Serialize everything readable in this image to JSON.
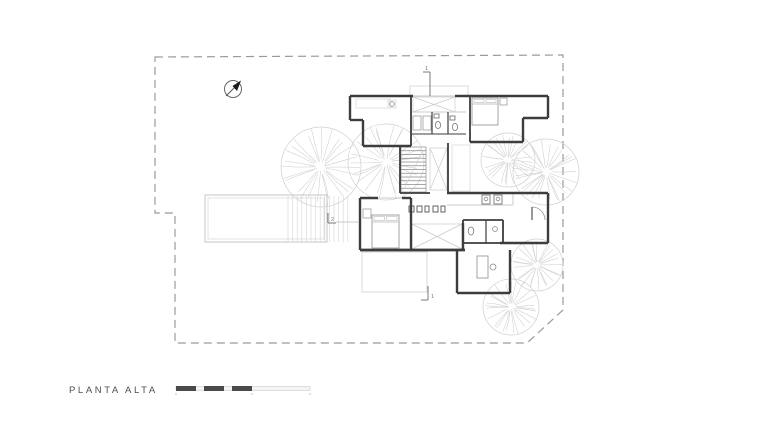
{
  "title": {
    "label": "PLANTA ALTA"
  },
  "colors": {
    "wall": "#3d3d3d",
    "light": "#c9c9c9",
    "lighter": "#dcdcdc",
    "medium": "#8d8d8d",
    "tree": "#cfcfcf",
    "boundary": "#9a9a9a",
    "text": "#4f4f4f",
    "marker": "#7a7a7a",
    "scale_dark": "#4a4a4a",
    "scale_light_fill": "#f4f4f4",
    "scale_light_stroke": "#d8d8d8"
  },
  "drawing": {
    "boundary_points": "155,57 563,55 563,310 527,343 175,343 175,213 155,213",
    "north_arrow": {
      "cx": 233,
      "cy": 89,
      "r": 8.5
    },
    "pool": {
      "outer": [
        205,
        195,
        122,
        47
      ],
      "inner": [
        208,
        198,
        116,
        41
      ]
    },
    "deck": {
      "x1": 288,
      "x2": 350,
      "y1": 196,
      "y2": 242,
      "step": 4.6
    },
    "trees": [
      {
        "cx": 321,
        "cy": 167,
        "r": 40
      },
      {
        "cx": 386,
        "cy": 162,
        "r": 38
      },
      {
        "cx": 508,
        "cy": 160,
        "r": 27
      },
      {
        "cx": 546,
        "cy": 172,
        "r": 33
      },
      {
        "cx": 537,
        "cy": 265,
        "r": 26
      },
      {
        "cx": 511,
        "cy": 307,
        "r": 28
      }
    ],
    "walls": [
      [
        350,
        96,
        413,
        96,
        2.4
      ],
      [
        455,
        96,
        548,
        96,
        2.4
      ],
      [
        350,
        96,
        350,
        120,
        2.4
      ],
      [
        350,
        120,
        363,
        120,
        2.4
      ],
      [
        363,
        120,
        363,
        146,
        2.4
      ],
      [
        363,
        146,
        411,
        146,
        2.4
      ],
      [
        411,
        96,
        411,
        146,
        1.8
      ],
      [
        470,
        96,
        470,
        142,
        1.8
      ],
      [
        548,
        96,
        548,
        118,
        2.4
      ],
      [
        523,
        118,
        548,
        118,
        2.4
      ],
      [
        523,
        118,
        523,
        142,
        2.4
      ],
      [
        470,
        142,
        523,
        142,
        2.4
      ],
      [
        448,
        143,
        448,
        193,
        1.8
      ],
      [
        400,
        147,
        400,
        193,
        1.8
      ],
      [
        400,
        193,
        430,
        193,
        1.8
      ],
      [
        447,
        193,
        548,
        193,
        2.4
      ],
      [
        548,
        193,
        548,
        243,
        2.4
      ],
      [
        500,
        243,
        548,
        243,
        2.4
      ],
      [
        463,
        220,
        503,
        220,
        1.8
      ],
      [
        463,
        220,
        463,
        243,
        1.8
      ],
      [
        503,
        220,
        503,
        243,
        1.8
      ],
      [
        486,
        220,
        486,
        243,
        1.2
      ],
      [
        463,
        243,
        503,
        243,
        1.8
      ],
      [
        360,
        198,
        360,
        250,
        2.4
      ],
      [
        360,
        198,
        378,
        198,
        2.4
      ],
      [
        402,
        198,
        411,
        198,
        2.4
      ],
      [
        411,
        198,
        411,
        223,
        2.4
      ],
      [
        360,
        250,
        465,
        250,
        2.8
      ],
      [
        411,
        223,
        411,
        250,
        2.4
      ],
      [
        463,
        223,
        463,
        250,
        2.4
      ],
      [
        457,
        250,
        457,
        293,
        2.4
      ],
      [
        457,
        293,
        510,
        293,
        2.4
      ],
      [
        510,
        250,
        510,
        293,
        2.4
      ],
      [
        432,
        112,
        432,
        134,
        1.2
      ],
      [
        448,
        112,
        448,
        134,
        1.2
      ],
      [
        412,
        134,
        466,
        134,
        1.0
      ]
    ],
    "light_lines": [
      [
        413,
        96,
        455,
        96
      ],
      [
        378,
        198,
        402,
        198
      ],
      [
        447,
        205,
        513,
        205
      ],
      [
        513,
        193,
        513,
        205
      ],
      [
        412,
        112,
        466,
        112
      ],
      [
        336,
        222,
        358,
        222
      ]
    ],
    "light_rects": [
      {
        "r": [
          410,
          86,
          58,
          10
        ],
        "s": "#d8d8d8"
      },
      {
        "r": [
          362,
          252,
          65,
          40
        ],
        "s": "#d4d4d4"
      },
      {
        "r": [
          356,
          99,
          34,
          9
        ],
        "s": "#dddddd"
      },
      {
        "r": [
          388,
          100,
          8,
          8
        ],
        "s": "#dddddd"
      },
      {
        "r": [
          452,
          145,
          18,
          46
        ],
        "s": "#dddddd"
      },
      {
        "r": [
          363,
          209,
          8,
          9
        ],
        "s": "#aaaaaa"
      },
      {
        "r": [
          500,
          98,
          7,
          7
        ],
        "s": "#aaaaaa"
      },
      {
        "r": [
          477,
          256,
          11,
          22
        ],
        "s": "#999999"
      },
      {
        "r": [
          482,
          195,
          8,
          9
        ],
        "s": "#777777"
      },
      {
        "r": [
          494,
          195,
          8,
          9
        ],
        "s": "#777777"
      },
      {
        "r": [
          413,
          116,
          8,
          14
        ],
        "s": "#aaaaaa"
      },
      {
        "r": [
          423,
          116,
          8,
          14
        ],
        "s": "#aaaaaa"
      },
      {
        "r": [
          434,
          114,
          5,
          4
        ],
        "s": "#777777"
      },
      {
        "r": [
          450,
          116,
          5,
          4
        ],
        "s": "#777777"
      },
      {
        "r": [
          409,
          206,
          5,
          6
        ],
        "s": "#555555"
      },
      {
        "r": [
          417,
          206,
          5,
          6
        ],
        "s": "#555555"
      },
      {
        "r": [
          425,
          206,
          4,
          6
        ],
        "s": "#555555"
      },
      {
        "r": [
          433,
          206,
          5,
          6
        ],
        "s": "#555555"
      },
      {
        "r": [
          441,
          206,
          4,
          6
        ],
        "s": "#555555"
      }
    ],
    "x_voids": [
      [
        413,
        97,
        42,
        15
      ],
      [
        430,
        148,
        17,
        42
      ],
      [
        412,
        224,
        50,
        25
      ]
    ],
    "stairs": {
      "x": 401,
      "y": 147,
      "w": 25,
      "h": 45,
      "treads": 12
    },
    "beds": [
      {
        "x": 472,
        "y": 98,
        "w": 26,
        "h": 27,
        "pillow": 6
      },
      {
        "x": 372,
        "y": 215,
        "w": 27,
        "h": 33,
        "pillow": 7
      }
    ],
    "ellipses": [
      {
        "cx": 438,
        "cy": 125,
        "rx": 2.6,
        "ry": 3.6
      },
      {
        "cx": 455,
        "cy": 127,
        "rx": 2.6,
        "ry": 3.6
      },
      {
        "cx": 471,
        "cy": 231,
        "rx": 2.8,
        "ry": 4.0
      }
    ],
    "circles": [
      {
        "cx": 493,
        "cy": 267,
        "r": 3.0
      },
      {
        "cx": 486,
        "cy": 199,
        "r": 1.8
      },
      {
        "cx": 498,
        "cy": 199,
        "r": 1.8
      },
      {
        "cx": 495,
        "cy": 229,
        "r": 2.4
      },
      {
        "cx": 392,
        "cy": 104,
        "r": 2.4
      }
    ],
    "door_arc": {
      "cx": 532,
      "cy": 220,
      "r": 13
    }
  },
  "section_markers": [
    {
      "label": "1",
      "line": [
        430,
        72,
        430,
        96
      ],
      "tick": [
        423,
        72,
        430,
        72
      ],
      "lx": 425,
      "ly": 70
    },
    {
      "label": "2",
      "line": [
        328,
        213,
        328,
        223
      ],
      "tick": [
        328,
        223,
        336,
        223
      ],
      "lx": 331,
      "ly": 221
    },
    {
      "label": "1",
      "line": [
        428,
        286,
        428,
        300
      ],
      "tick": [
        421,
        300,
        428,
        300
      ],
      "lx": 431,
      "ly": 298
    }
  ],
  "scale_bar": {
    "y": 386,
    "h": 5,
    "light": {
      "x": 176,
      "w": 134
    },
    "dark_segments": [
      [
        176,
        20
      ],
      [
        204,
        20
      ],
      [
        232,
        20
      ]
    ],
    "ticks": [
      176,
      252,
      310
    ]
  }
}
